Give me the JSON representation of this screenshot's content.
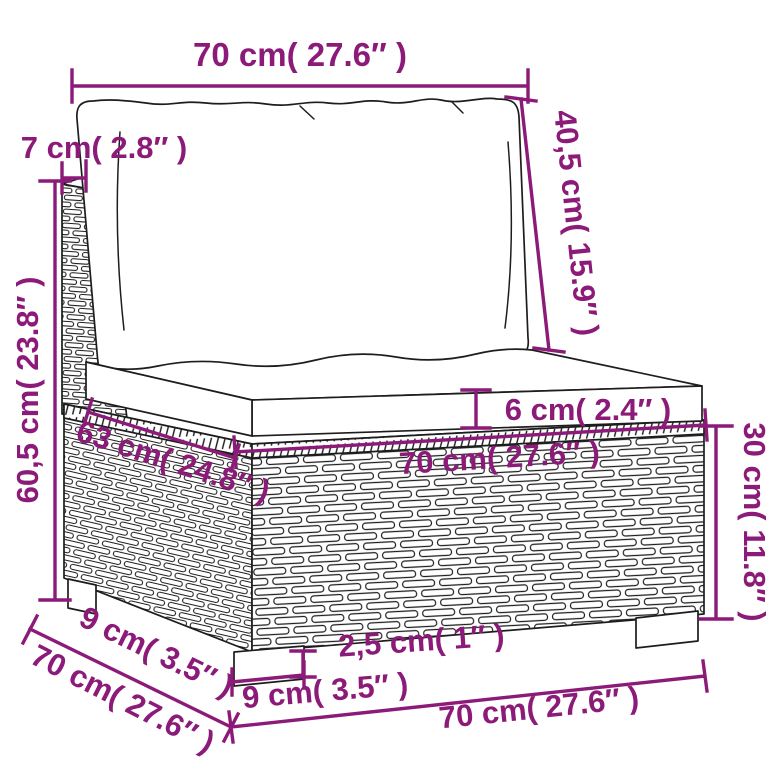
{
  "colors": {
    "annotation": "#8c1a78",
    "outline": "#1d1d1d",
    "background": "#ffffff"
  },
  "annotations": {
    "top_width": {
      "label": "70 cm( 27.6″ )"
    },
    "back_depth": {
      "label": "7 cm( 2.8″ )"
    },
    "total_height": {
      "label": "60,5 cm( 23.8″ )"
    },
    "back_cushion_height": {
      "label": "40,5 cm( 15.9″ )"
    },
    "cushion_thickness": {
      "label": "6 cm( 2.4″ )"
    },
    "seat_depth": {
      "label": "63 cm( 24.8″ )"
    },
    "seat_width": {
      "label": "70 cm( 27.6″ )"
    },
    "base_height": {
      "label": "30 cm( 11.8″ )"
    },
    "leg_height": {
      "label": "2,5 cm( 1″ )"
    },
    "leg_width": {
      "label": "9 cm( 3.5″ )"
    },
    "leg_depth": {
      "label": "9 cm( 3.5″ )"
    },
    "total_depth": {
      "label": "70 cm( 27.6″ )"
    },
    "bottom_width": {
      "label": "70 cm( 27.6″ )"
    }
  }
}
